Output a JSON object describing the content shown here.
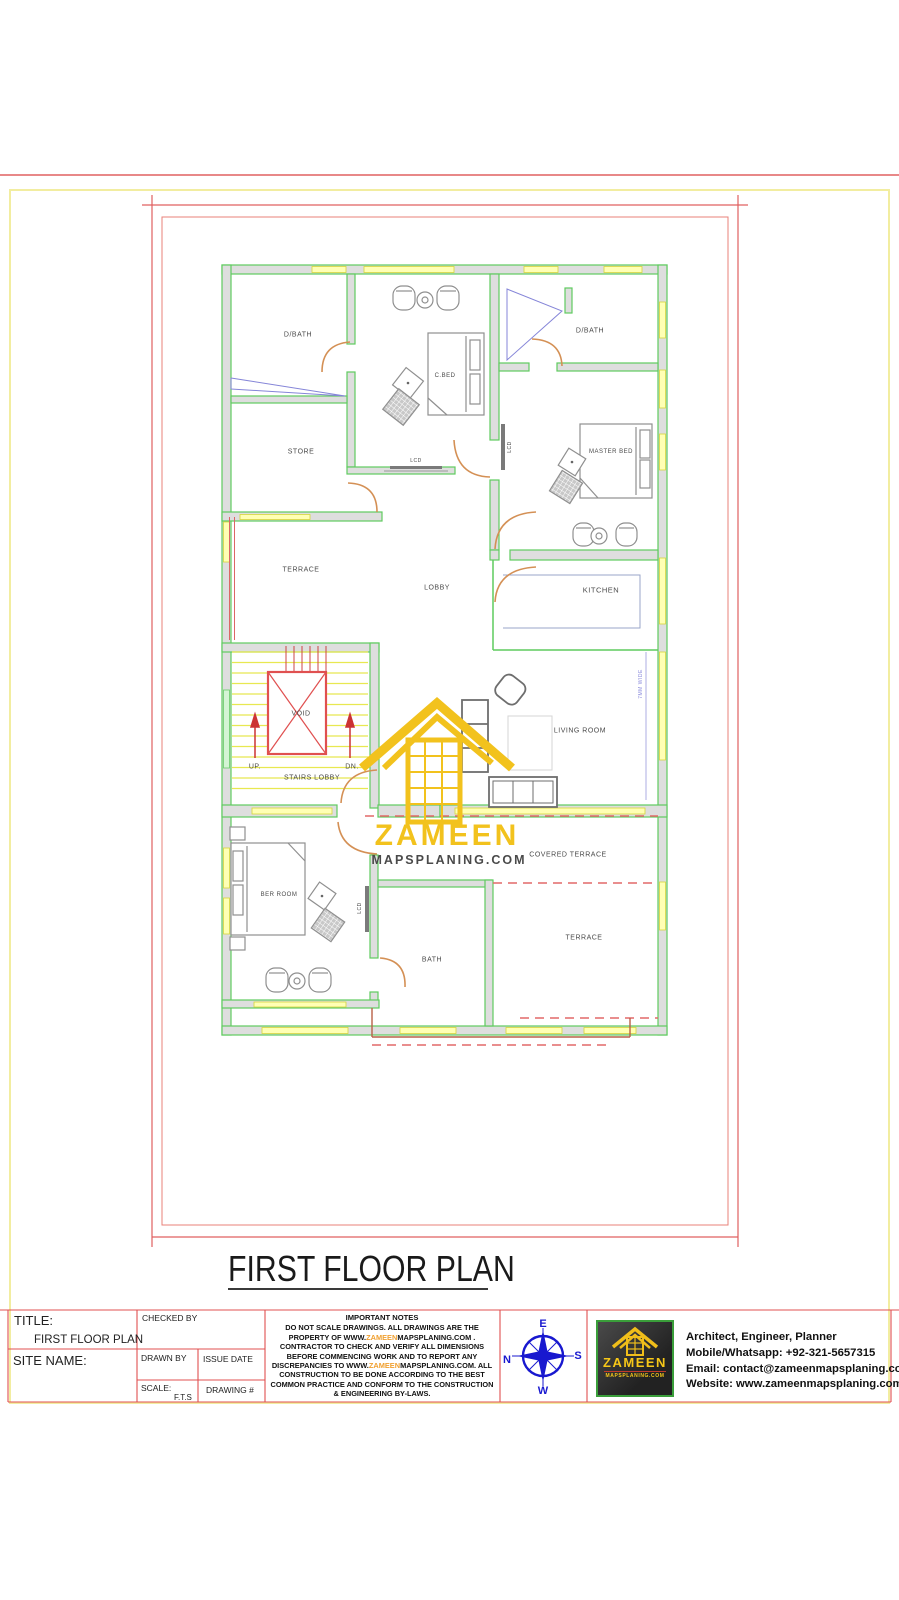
{
  "page": {
    "heading": "FIRST FLOOR PLAN"
  },
  "plan": {
    "rooms": {
      "dbath_left": "D/BATH",
      "cbed": "C.BED",
      "dbath_right": "D/BATH",
      "store": "STORE",
      "master_bed": "MASTER BED",
      "terrace_upper": "TERRACE",
      "lobby": "LOBBY",
      "kitchen": "KITCHEN",
      "living_room": "LIVING ROOM",
      "covered_terrace": "COVERED TERRACE",
      "ber_room": "BER ROOM",
      "bath": "BATH",
      "terrace_lower": "TERRACE"
    },
    "stairs": {
      "void": "VOID",
      "up": "UP.",
      "dn": "DN.",
      "label": "STAIRS LOBBY"
    },
    "annotations": {
      "lcd": "LCD",
      "wall_note": "7MM WIDE"
    },
    "watermark": {
      "name": "ZAMEEN",
      "domain": "MAPSPLANING.COM"
    }
  },
  "title_block": {
    "title_label": "TITLE:",
    "title_value": "FIRST FLOOR PLAN",
    "site_label": "SITE NAME:",
    "checked_by": "CHECKED BY",
    "drawn_by": "DRAWN BY",
    "issue_date": "ISSUE DATE",
    "scale_label": "SCALE:",
    "scale_value": "F.T.S",
    "drawing_label": "DRAWING #"
  },
  "notes": {
    "heading": "IMPORTANT NOTES",
    "seg1": "DO NOT SCALE DRAWINGS. ALL DRAWINGS ARE THE PROPERTY OF WWW.",
    "brand1": "ZAMEEN",
    "seg2": "MAPSPLANING.COM . CONTRACTOR TO CHECK AND VERIFY ALL DIMENSIONS BEFORE COMMENCING WORK AND TO REPORT ANY DISCREPANCIES TO WWW.",
    "brand2": "ZAMEEN",
    "seg3": "MAPSPLANING.COM. ALL CONSTRUCTION TO BE DONE ACCORDING TO THE BEST COMMON PRACTICE AND CONFORM TO THE CONSTRUCTION & ENGINEERING BY-LAWS."
  },
  "compass": {
    "n": "N",
    "e": "E",
    "s": "S",
    "w": "W"
  },
  "brand_panel": {
    "logo_text": "ZAMEEN",
    "logo_sub": "MAPSPLANING.COM",
    "line1": "Architect, Engineer, Planner",
    "line2": "Mobile/Whatsapp: +92-321-5657315",
    "line3": "Email: contact@zameenmapsplaning.com",
    "line4": "Website: www.zameenmapsplaning.com"
  },
  "colors": {
    "wall_green": "#5fcb5f",
    "window_yellow": "#ffffb4",
    "door_orange": "#d49055",
    "accent_red": "#e05050",
    "brand_yellow": "#f2c21d",
    "compass_blue": "#1818cf"
  }
}
